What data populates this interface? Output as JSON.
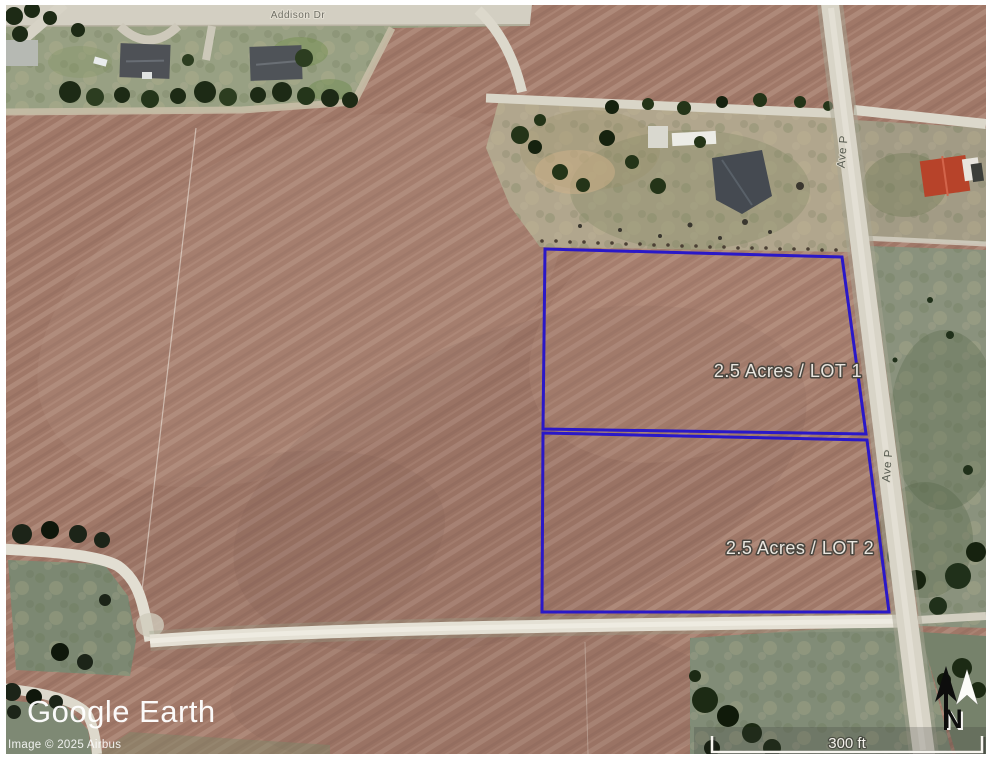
{
  "map": {
    "provider_logo": "Google Earth",
    "copyright": "Image © 2025 Airbus",
    "roads": {
      "top_street": "Addison Dr",
      "side_street": "Ave P"
    },
    "lots": [
      {
        "label": "2.5 Acres / LOT 1"
      },
      {
        "label": "2.5 Acres / LOT 2"
      }
    ],
    "outline_color": "#2a18c8",
    "scale_bar": {
      "label": "300 ft"
    },
    "compass": {
      "label": "N"
    },
    "colors": {
      "plowed_field": "#a07868",
      "pasture_green": "#8a927d",
      "pasture_tan": "#b1a68d",
      "road_light": "#d8d4c7",
      "tree_dark": "#1f2d16",
      "frame": "#ffffff",
      "label_text": "#e9e6df"
    }
  }
}
